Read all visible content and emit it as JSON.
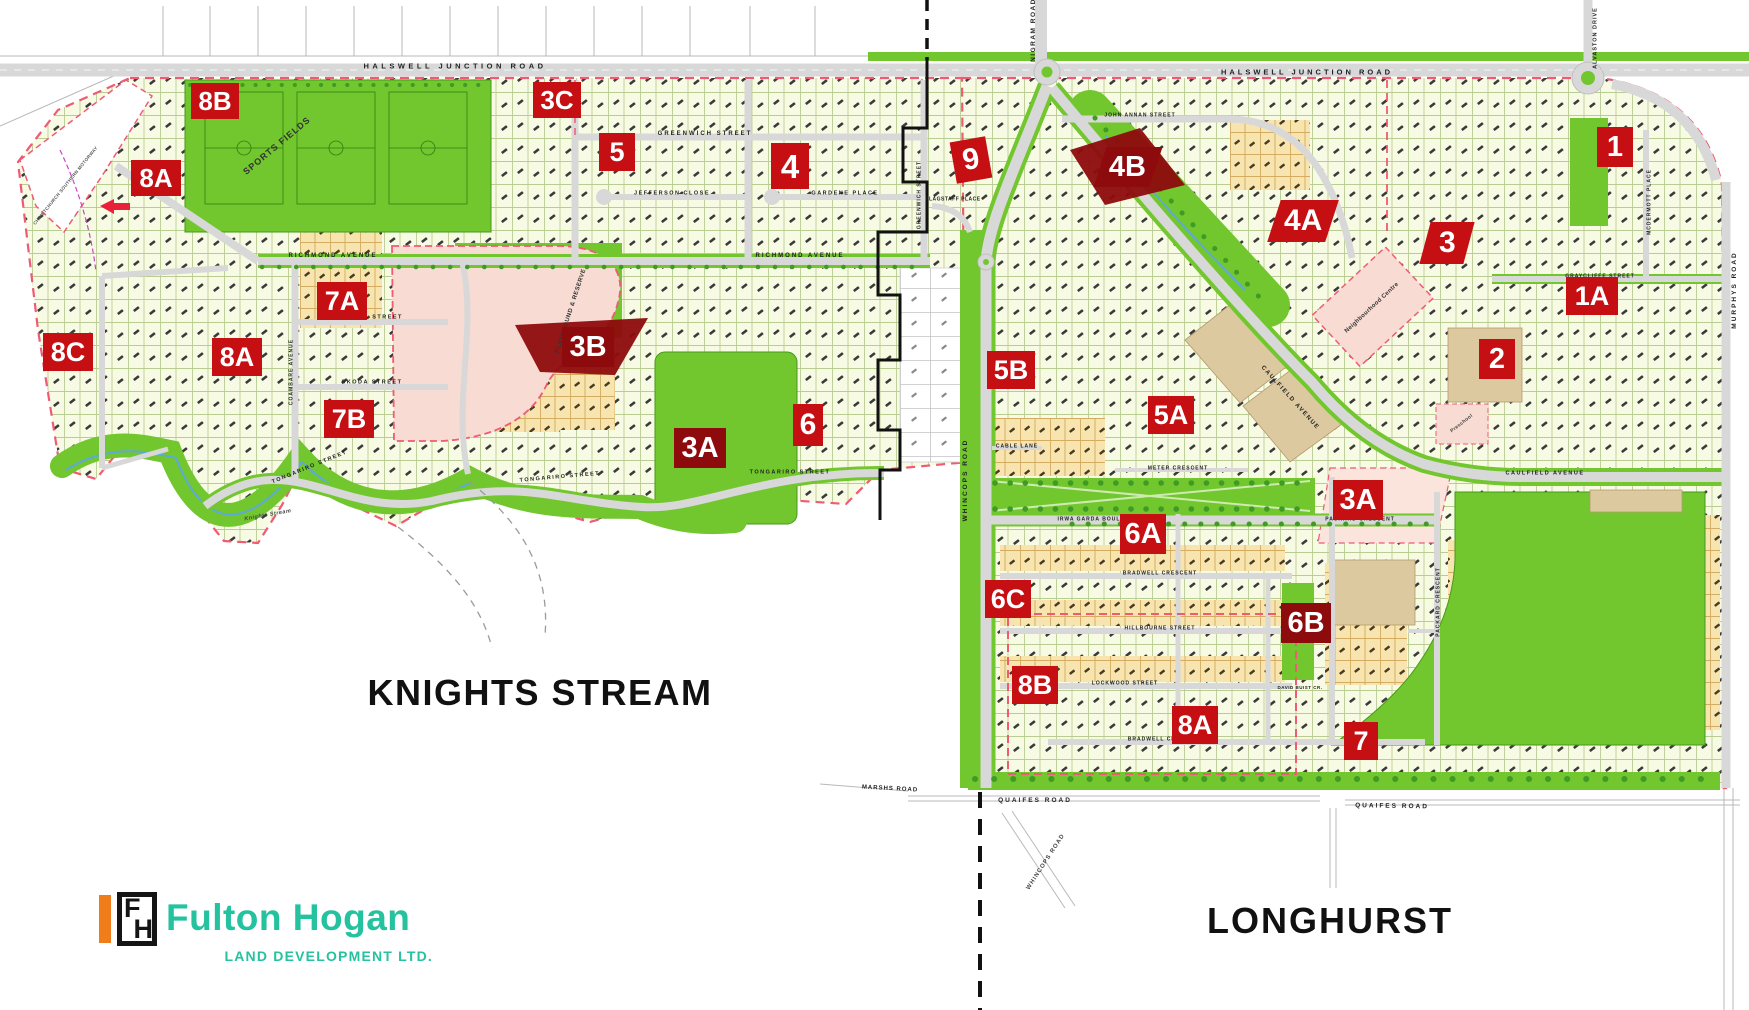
{
  "colors": {
    "map_green": "#72C62E",
    "marker_red": "#C50F13",
    "marker_dark_red": "#8E0B0D",
    "boundary_pink": "#EF5A75",
    "road_grey": "#D8D8D8",
    "pink_area": "#F8DCD3",
    "tan_area": "#DCC9A0",
    "stream_blue": "#5FA8DC",
    "logo_teal": "#25C2A0",
    "logo_orange": "#F07D1A",
    "title_black": "#111111"
  },
  "logo": {
    "brand": "Fulton Hogan",
    "subtitle": "LAND DEVELOPMENT LTD.",
    "icon_f": "F",
    "icon_h": "H"
  },
  "map": {
    "stage_markers": [
      {
        "id": "8b-ks",
        "label": "8B",
        "x": 215,
        "y": 101,
        "w": 48,
        "h": 36
      },
      {
        "id": "3c",
        "label": "3C",
        "x": 557,
        "y": 100,
        "w": 48,
        "h": 36
      },
      {
        "id": "8a-nw",
        "label": "8A",
        "x": 156,
        "y": 178,
        "w": 50,
        "h": 36
      },
      {
        "id": "5",
        "label": "5",
        "x": 617,
        "y": 152,
        "w": 36,
        "h": 38
      },
      {
        "id": "4",
        "label": "4",
        "x": 790,
        "y": 166,
        "w": 38,
        "h": 46
      },
      {
        "id": "9",
        "label": "9",
        "x": 971,
        "y": 160,
        "w": 36,
        "h": 42,
        "rotate": -10
      },
      {
        "id": "4b",
        "label": "4B",
        "x": 1128,
        "y": 167,
        "w": 56,
        "h": 40,
        "variant": "dark",
        "skew": -18
      },
      {
        "id": "4a",
        "label": "4A",
        "x": 1303,
        "y": 221,
        "w": 58,
        "h": 42,
        "skew": -18
      },
      {
        "id": "1",
        "label": "1",
        "x": 1615,
        "y": 147,
        "w": 36,
        "h": 40
      },
      {
        "id": "3",
        "label": "3",
        "x": 1447,
        "y": 243,
        "w": 44,
        "h": 42,
        "skew": -15
      },
      {
        "id": "1a",
        "label": "1A",
        "x": 1592,
        "y": 296,
        "w": 52,
        "h": 38
      },
      {
        "id": "7a",
        "label": "7A",
        "x": 342,
        "y": 301,
        "w": 50,
        "h": 38
      },
      {
        "id": "3b",
        "label": "3B",
        "x": 588,
        "y": 347,
        "w": 52,
        "h": 40,
        "variant": "dark"
      },
      {
        "id": "2",
        "label": "2",
        "x": 1497,
        "y": 359,
        "w": 36,
        "h": 40
      },
      {
        "id": "8c",
        "label": "8C",
        "x": 68,
        "y": 352,
        "w": 50,
        "h": 38
      },
      {
        "id": "8a-w",
        "label": "8A",
        "x": 237,
        "y": 357,
        "w": 50,
        "h": 38
      },
      {
        "id": "5b",
        "label": "5B",
        "x": 1011,
        "y": 370,
        "w": 48,
        "h": 38
      },
      {
        "id": "5a",
        "label": "5A",
        "x": 1171,
        "y": 415,
        "w": 46,
        "h": 38
      },
      {
        "id": "7b",
        "label": "7B",
        "x": 349,
        "y": 419,
        "w": 50,
        "h": 38
      },
      {
        "id": "3a-ks",
        "label": "3A",
        "x": 700,
        "y": 448,
        "w": 52,
        "h": 40,
        "variant": "dark"
      },
      {
        "id": "6",
        "label": "6",
        "x": 808,
        "y": 425,
        "w": 30,
        "h": 42
      },
      {
        "id": "3a-lh",
        "label": "3A",
        "x": 1358,
        "y": 500,
        "w": 50,
        "h": 40
      },
      {
        "id": "6a",
        "label": "6A",
        "x": 1143,
        "y": 534,
        "w": 46,
        "h": 40
      },
      {
        "id": "6c",
        "label": "6C",
        "x": 1008,
        "y": 599,
        "w": 46,
        "h": 38
      },
      {
        "id": "6b",
        "label": "6B",
        "x": 1306,
        "y": 623,
        "w": 50,
        "h": 40,
        "variant": "dark"
      },
      {
        "id": "8b-lh",
        "label": "8B",
        "x": 1035,
        "y": 685,
        "w": 46,
        "h": 38
      },
      {
        "id": "8a-lh",
        "label": "8A",
        "x": 1195,
        "y": 725,
        "w": 46,
        "h": 38
      },
      {
        "id": "7",
        "label": "7",
        "x": 1361,
        "y": 741,
        "w": 34,
        "h": 38
      }
    ],
    "labels": [
      {
        "id": "knights-stream-title",
        "text": "KNIGHTS STREAM",
        "x": 540,
        "y": 693,
        "rot": 0,
        "size": 36,
        "spacing": 1.5,
        "color": "#111111",
        "weight": 800
      },
      {
        "id": "longhurst-title",
        "text": "LONGHURST",
        "x": 1330,
        "y": 921,
        "rot": 0,
        "size": 36,
        "spacing": 2,
        "color": "#111111",
        "weight": 800
      },
      {
        "id": "halswell-junction-road-w",
        "text": "HALSWELL JUNCTION ROAD",
        "x": 455,
        "y": 66,
        "rot": 0,
        "size": 7.5,
        "spacing": 3.5,
        "color": "#222222"
      },
      {
        "id": "halswell-junction-road-e",
        "text": "HALSWELL JUNCTION ROAD",
        "x": 1307,
        "y": 72,
        "rot": 0,
        "size": 7.5,
        "spacing": 3,
        "color": "#222222"
      },
      {
        "id": "nigram-road",
        "text": "NIGRAM ROAD",
        "x": 1034,
        "y": 30,
        "rot": -90,
        "size": 6.5,
        "spacing": 1.5,
        "color": "#222222"
      },
      {
        "id": "alvaston-drive",
        "text": "ALVASTON DRIVE",
        "x": 1596,
        "y": 38,
        "rot": -90,
        "size": 5.5,
        "spacing": 1,
        "color": "#222222"
      },
      {
        "id": "murphys-road",
        "text": "MURPHYS ROAD",
        "x": 1735,
        "y": 290,
        "rot": -90,
        "size": 6.5,
        "spacing": 2,
        "color": "#222222"
      },
      {
        "id": "whincops-road",
        "text": "WHINCOPS ROAD",
        "x": 966,
        "y": 480,
        "rot": -90,
        "size": 6.5,
        "spacing": 2,
        "color": "#222222"
      },
      {
        "id": "whincops-road-s",
        "text": "WHINCOPS ROAD",
        "x": 1046,
        "y": 862,
        "rot": -57,
        "size": 6,
        "spacing": 1,
        "color": "#444444"
      },
      {
        "id": "quaifes-road-w",
        "text": "QUAIFES ROAD",
        "x": 1035,
        "y": 801,
        "rot": 0,
        "size": 6.5,
        "spacing": 2,
        "color": "#222222"
      },
      {
        "id": "quaifes-road-e",
        "text": "QUAIFES ROAD",
        "x": 1392,
        "y": 807,
        "rot": 1,
        "size": 6.5,
        "spacing": 2,
        "color": "#222222"
      },
      {
        "id": "marshs-road",
        "text": "MARSHS ROAD",
        "x": 890,
        "y": 789,
        "rot": 3,
        "size": 6,
        "spacing": 1,
        "color": "#222222"
      },
      {
        "id": "richmond-avenue-w",
        "text": "RICHMOND AVENUE",
        "x": 333,
        "y": 256,
        "rot": 0,
        "size": 6,
        "spacing": 2,
        "color": "#222222"
      },
      {
        "id": "richmond-avenue-e",
        "text": "RICHMOND AVENUE",
        "x": 800,
        "y": 256,
        "rot": 0,
        "size": 6,
        "spacing": 2,
        "color": "#222222"
      },
      {
        "id": "greenwich-street",
        "text": "GREENWICH STREET",
        "x": 705,
        "y": 134,
        "rot": 0,
        "size": 6,
        "spacing": 2,
        "color": "#222222"
      },
      {
        "id": "greenwich-street-v",
        "text": "GREENWICH STREET",
        "x": 920,
        "y": 195,
        "rot": -90,
        "size": 5,
        "spacing": 1,
        "color": "#222222"
      },
      {
        "id": "jefferson-close",
        "text": "JEFFERSON CLOSE",
        "x": 672,
        "y": 194,
        "rot": 0,
        "size": 5.5,
        "spacing": 1.5,
        "color": "#222222"
      },
      {
        "id": "gardene-place",
        "text": "GARDENE PLACE",
        "x": 845,
        "y": 194,
        "rot": 0,
        "size": 5.5,
        "spacing": 1.5,
        "color": "#222222"
      },
      {
        "id": "flagstaff-place",
        "text": "FLAGSTAFF PLACE",
        "x": 953,
        "y": 200,
        "rot": 0,
        "size": 5,
        "spacing": 0.5,
        "color": "#222222"
      },
      {
        "id": "tongariro-street-w",
        "text": "TONGARIRO STREET",
        "x": 310,
        "y": 468,
        "rot": -22,
        "size": 5.5,
        "spacing": 1.5,
        "color": "#222222"
      },
      {
        "id": "tongariro-street-c",
        "text": "TONGARIRO STREET",
        "x": 560,
        "y": 478,
        "rot": -5,
        "size": 5.5,
        "spacing": 1.5,
        "color": "#222222"
      },
      {
        "id": "tongariro-street-e",
        "text": "TONGARIRO STREET",
        "x": 790,
        "y": 473,
        "rot": 0,
        "size": 5.5,
        "spacing": 1.5,
        "color": "#222222"
      },
      {
        "id": "bouma-street",
        "text": "BOUMA STREET",
        "x": 372,
        "y": 318,
        "rot": 0,
        "size": 5.5,
        "spacing": 1.5,
        "color": "#222222"
      },
      {
        "id": "skoda-street",
        "text": "SKODA STREET",
        "x": 372,
        "y": 383,
        "rot": 0,
        "size": 5.5,
        "spacing": 1.5,
        "color": "#222222"
      },
      {
        "id": "coambare-avenue",
        "text": "COAMBARE AVENUE",
        "x": 292,
        "y": 372,
        "rot": -90,
        "size": 5,
        "spacing": 1,
        "color": "#222222"
      },
      {
        "id": "sports-fields",
        "text": "SPORTS FIELDS",
        "x": 277,
        "y": 146,
        "rot": -40,
        "size": 9,
        "spacing": 1,
        "color": "#333333"
      },
      {
        "id": "playground-reserve",
        "text": "PLAYGROUND & RESERVE",
        "x": 571,
        "y": 311,
        "rot": -72,
        "size": 6,
        "spacing": 0.5,
        "color": "#333333"
      },
      {
        "id": "knights-stream-waterway",
        "text": "Knights Stream",
        "x": 268,
        "y": 516,
        "rot": -10,
        "size": 5.5,
        "spacing": 0.5,
        "color": "#444444",
        "italic": 1
      },
      {
        "id": "john-annan-street",
        "text": "JOHN ANNAN STREET",
        "x": 1140,
        "y": 116,
        "rot": 0,
        "size": 5,
        "spacing": 1,
        "color": "#222222"
      },
      {
        "id": "caulfield-avenue-diag",
        "text": "CAULFIELD AVENUE",
        "x": 1290,
        "y": 398,
        "rot": 48,
        "size": 6,
        "spacing": 1.5,
        "color": "#222222"
      },
      {
        "id": "caulfield-avenue-e",
        "text": "CAULFIELD AVENUE",
        "x": 1545,
        "y": 474,
        "rot": 0,
        "size": 5.5,
        "spacing": 1.5,
        "color": "#222222"
      },
      {
        "id": "graycliffe-street",
        "text": "GRAYCLIFFE STREET",
        "x": 1600,
        "y": 277,
        "rot": 0,
        "size": 5,
        "spacing": 1,
        "color": "#222222"
      },
      {
        "id": "mcdermott-place",
        "text": "MCDERMOTT PLACE",
        "x": 1650,
        "y": 202,
        "rot": -90,
        "size": 5,
        "spacing": 1,
        "color": "#222222"
      },
      {
        "id": "cable-lane",
        "text": "CABLE LANE",
        "x": 1017,
        "y": 447,
        "rot": 0,
        "size": 5,
        "spacing": 1,
        "color": "#222222"
      },
      {
        "id": "meter-crescent",
        "text": "METER CRESCENT",
        "x": 1178,
        "y": 469,
        "rot": 0,
        "size": 5,
        "spacing": 1,
        "color": "#222222"
      },
      {
        "id": "irwa-garda-boulevard",
        "text": "IRWA GARDA BOULEVARD",
        "x": 1100,
        "y": 520,
        "rot": 0,
        "size": 5,
        "spacing": 1,
        "color": "#222222"
      },
      {
        "id": "packard-crescent-n",
        "text": "PACKARD CRESCENT",
        "x": 1360,
        "y": 520,
        "rot": 0,
        "size": 5,
        "spacing": 1,
        "color": "#222222"
      },
      {
        "id": "bradwell-crescent-n",
        "text": "BRADWELL CRESCENT",
        "x": 1160,
        "y": 574,
        "rot": 0,
        "size": 5,
        "spacing": 1,
        "color": "#222222"
      },
      {
        "id": "hillbourne-street",
        "text": "HILLBOURNE STREET",
        "x": 1160,
        "y": 629,
        "rot": 0,
        "size": 5,
        "spacing": 1,
        "color": "#222222"
      },
      {
        "id": "lockwood-street",
        "text": "LOCKWOOD STREET",
        "x": 1125,
        "y": 684,
        "rot": 0,
        "size": 5,
        "spacing": 1,
        "color": "#222222"
      },
      {
        "id": "david-buist-crescent",
        "text": "DAVID BUIST CR.",
        "x": 1300,
        "y": 688,
        "rot": 0,
        "size": 4.5,
        "spacing": 0.5,
        "color": "#222222"
      },
      {
        "id": "bradwell-crescent-s",
        "text": "BRADWELL CRESCENT",
        "x": 1165,
        "y": 740,
        "rot": 0,
        "size": 5,
        "spacing": 1,
        "color": "#222222"
      },
      {
        "id": "packard-crescent-v",
        "text": "PACKARD CRESCENT",
        "x": 1439,
        "y": 602,
        "rot": -90,
        "size": 5,
        "spacing": 1,
        "color": "#222222"
      },
      {
        "id": "neighbourhood-centre",
        "text": "Neighbourhood Centre",
        "x": 1372,
        "y": 308,
        "rot": -43,
        "size": 6,
        "spacing": 0.3,
        "color": "#333333"
      },
      {
        "id": "preschool",
        "text": "Preschool",
        "x": 1462,
        "y": 424,
        "rot": -38,
        "size": 5,
        "spacing": 0.3,
        "color": "#444444"
      },
      {
        "id": "motorway-note",
        "text": "CHRISTCHURCH SOUTHERN MOTORWAY",
        "x": 66,
        "y": 186,
        "rot": -51,
        "size": 4.5,
        "spacing": 0.3,
        "color": "#555555"
      }
    ]
  }
}
